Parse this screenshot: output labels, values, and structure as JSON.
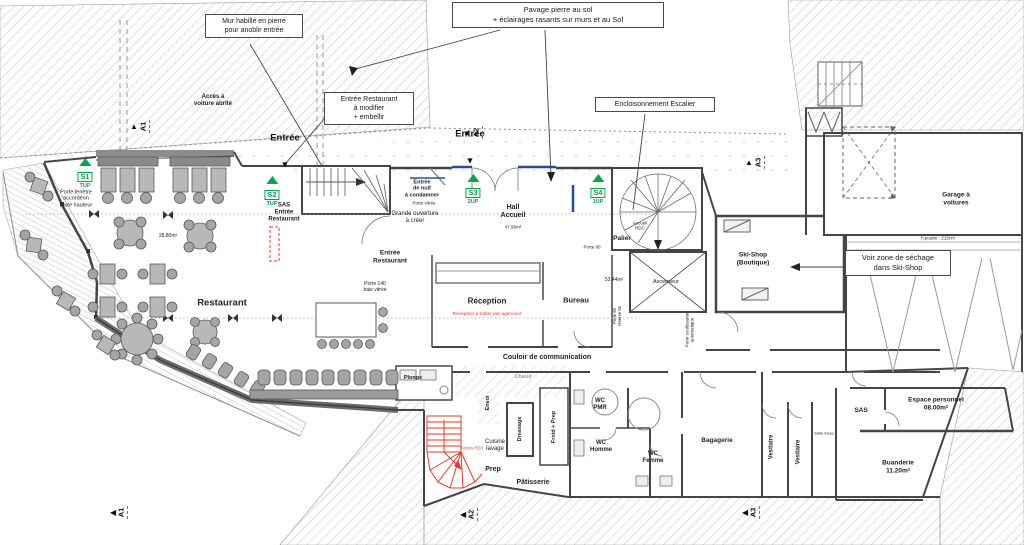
{
  "colors": {
    "accent_green": "#00A651",
    "accent_red": "#E23B2E",
    "accent_blue": "#2A4D9B",
    "wall": "#454545",
    "hatch_line": "#C6C6C6"
  },
  "callouts": {
    "mur": "Mur habillé en pierre\npour anoblir entrée",
    "pavage": "Pavage pierre au sol\n+ éclairages rasants sur murs et au Sol",
    "entree_restaurant": "Entrée Restaurant\nà modifier\n+ embellir",
    "encloisonnement": "Encloisonnement Escalier",
    "sechage": "Voir zone de séchage\ndans Ski-Shop"
  },
  "entrances": {
    "left": "Entrée",
    "right": "Entrée"
  },
  "icons": {
    "down_arrow": "▼",
    "up_arrow": "▲",
    "left_arrow": "◀"
  },
  "stair_markers": [
    {
      "id": "S1",
      "dir": "TUP"
    },
    {
      "id": "S2",
      "dir": "TUP"
    },
    {
      "id": "S3",
      "dir": "2UP"
    },
    {
      "id": "S4",
      "dir": "1UP"
    }
  ],
  "section_markers": [
    "A1",
    "A2",
    "A3"
  ],
  "rooms": {
    "restaurant": "Restaurant",
    "hall": "Hall\nAccueil",
    "reception": "Réception",
    "bureau": "Bureau",
    "couloir": "Couloir de communication",
    "ascenseur": "Ascenseur",
    "palier": "Palier",
    "skishop": "Ski-Shop\n(Boutique)",
    "garage": "Garage à\nvoitures",
    "plonge": "Plonge",
    "chaud": "Chaud",
    "envoi": "Envoi",
    "dressage": "Dressage",
    "cuisine_lavage": "Cuisine\nlavage",
    "froid_prep": "Froid + Prep",
    "prep": "Prep",
    "patisserie": "Pâtisserie",
    "wc_pmr": "WC\nPMR",
    "wc_homme": "WC\nHomme",
    "wc_femme": "WC\nFemme",
    "bagagerie": "Bagagerie",
    "vestiaire1": "Vestiaire",
    "vestiaire2": "Vestiaire",
    "salle_eau": "Salle d'eau",
    "sas_perso": "SAS",
    "espace_personnel": "Espace personnel\n08.00m²",
    "buanderie": "Buanderie\n11.20m²",
    "sas_entree": "SAS\nEntrée\nRestaurant"
  },
  "areas": {
    "hall": "47.96m²",
    "restaurant": "28.80m²",
    "zone_bureau": "53.44m²"
  },
  "notes": {
    "acces_voiture": "Accès à\nvoiture abrité",
    "porte_fenetre": "Porte fenêtre\naccordéon\ntoute hauteur",
    "entree_nuit": "Entrée\nde nuit\nà condamner",
    "porte_vitree": "Porte vitrée",
    "grande_ouverture": "Grande ouverture\nà créer",
    "entree_restaurant": "Entrée\nRestaurant",
    "porte_140": "Porte 140\nbaie vitrée",
    "reception_note": "Réception à traiter par agenceur",
    "porte_90": "Porte 90",
    "accueil_rdc": "Accueil\nRDC",
    "porte_coulissante": "Porte coulissante\nautomatique",
    "porte_90_reserve": "Porte 90\nréserve 55",
    "hpoutre": "h.poutre : 215cm",
    "acces_rdj": "Accès RDJ"
  }
}
